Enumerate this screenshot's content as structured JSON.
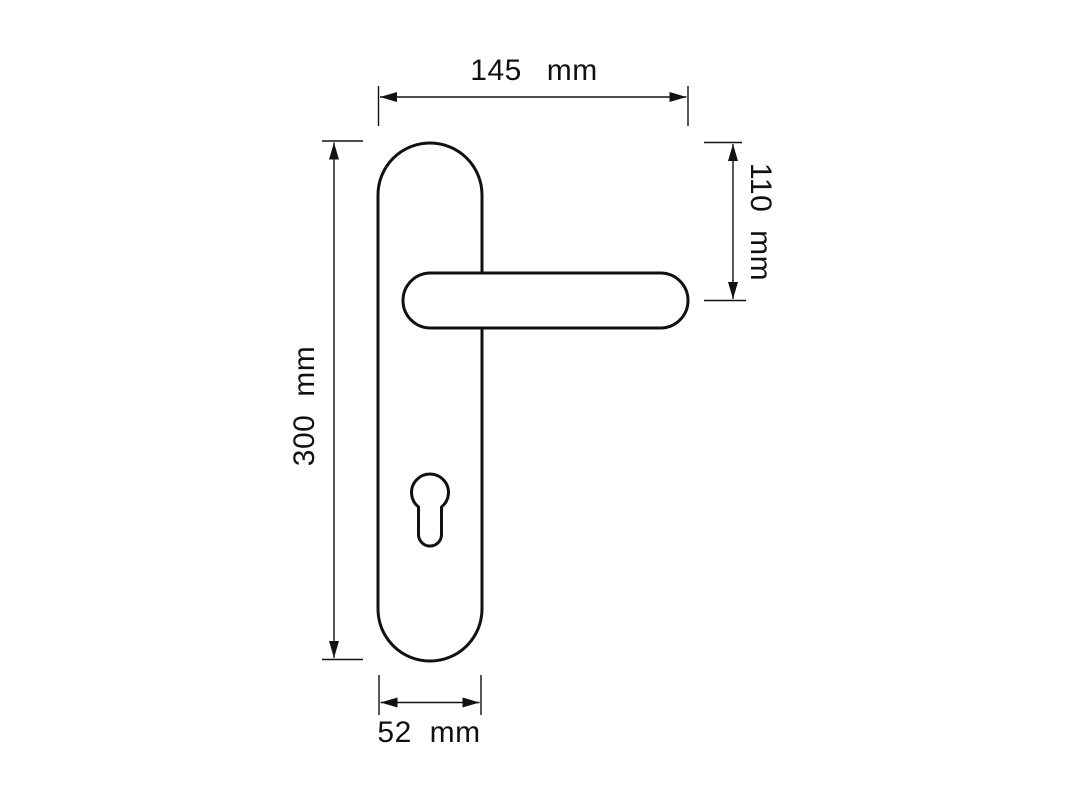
{
  "figure": {
    "type": "technical-dimension-drawing",
    "subject": "door lever handle on long backplate with euro-profile keyhole"
  },
  "colors": {
    "background": "#ffffff",
    "line": "#111111"
  },
  "dimensions": {
    "overall_width": {
      "value": "145",
      "unit": "mm"
    },
    "top_to_lever_offset": {
      "value": "110",
      "unit": "mm"
    },
    "plate_height": {
      "value": "300",
      "unit": "mm"
    },
    "plate_width": {
      "value": "52",
      "unit": "mm"
    }
  }
}
